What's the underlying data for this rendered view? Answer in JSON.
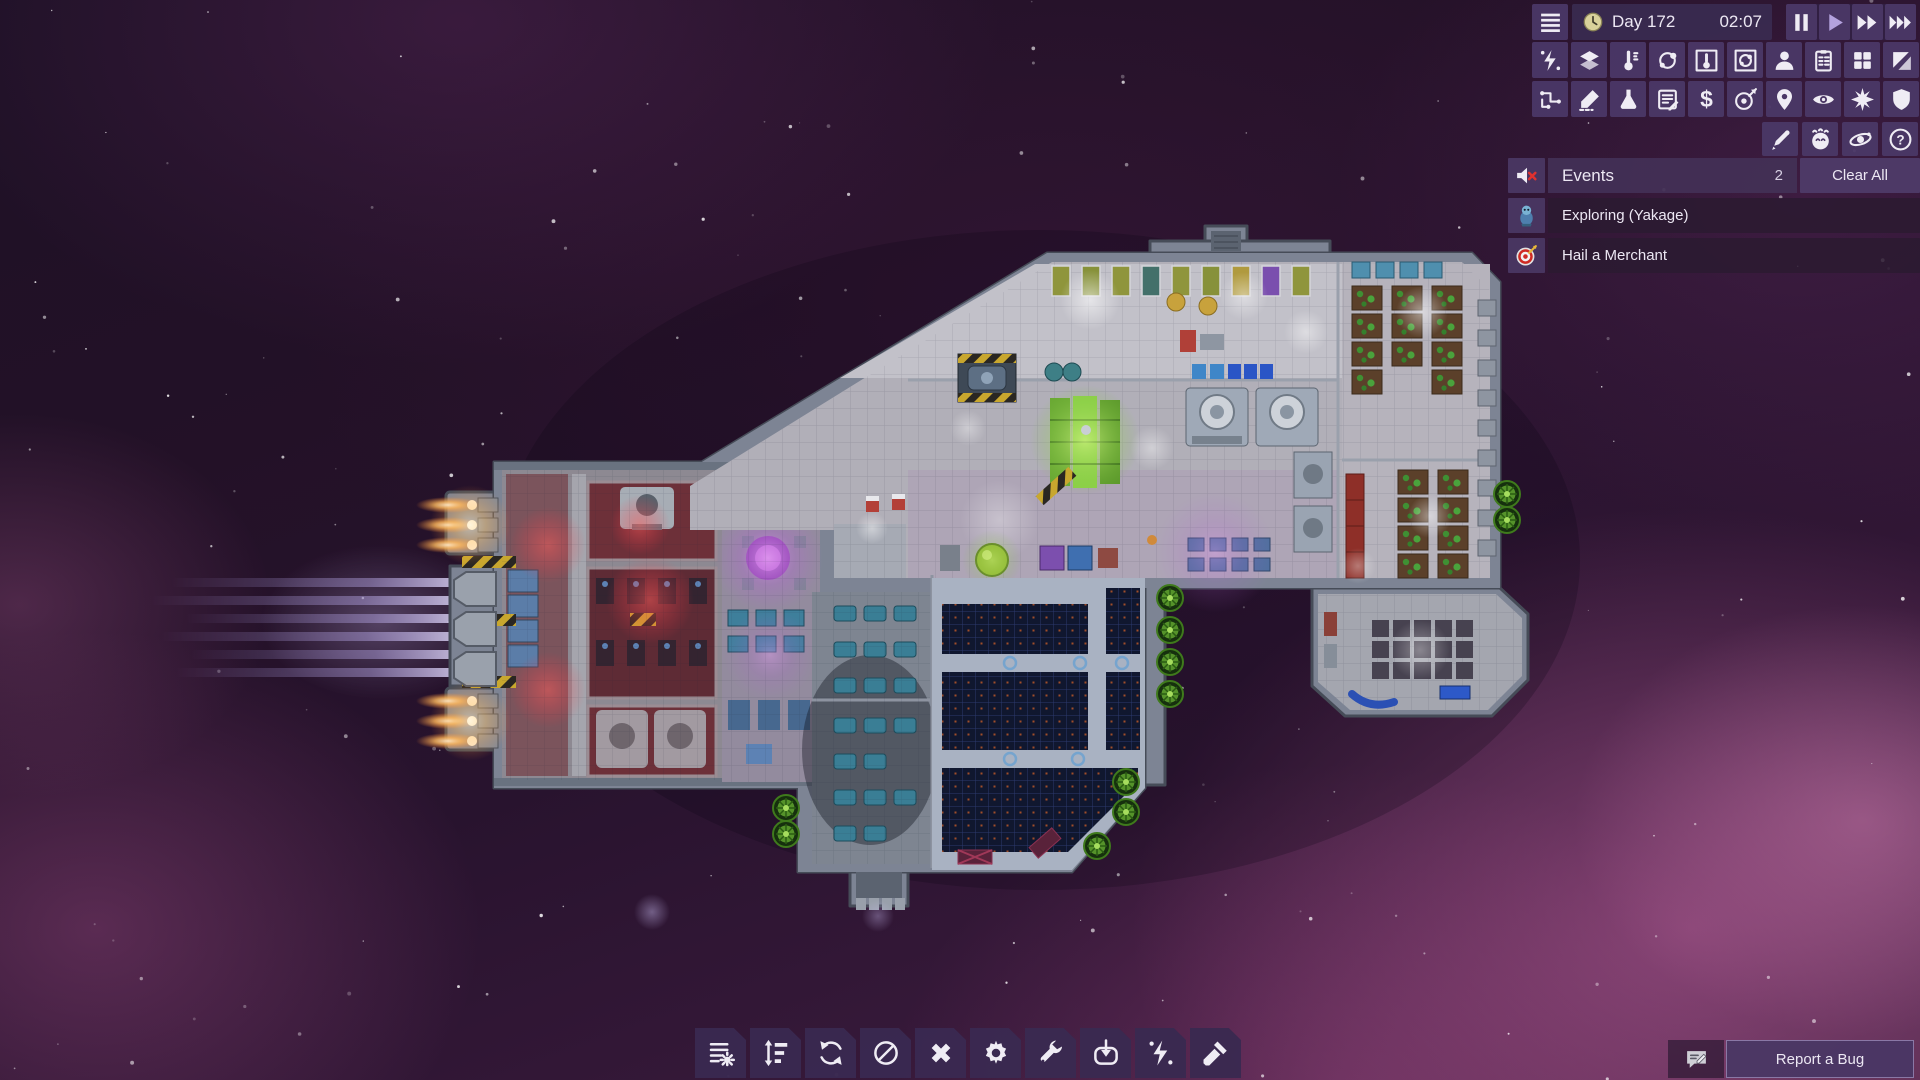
{
  "hud": {
    "menu_icon": "hamburger-menu",
    "clock_icon": "clock",
    "day": "Day 172",
    "time": "02:07",
    "speed_controls": [
      "pause",
      "play",
      "fast-forward",
      "fastest-forward"
    ],
    "active_speed": "play"
  },
  "toolbar": {
    "row1": [
      "power",
      "layers",
      "temperature",
      "gas",
      "temperature-overlay",
      "gas-overlay",
      "crew",
      "tasks-clipboard",
      "rooms-grid",
      "floor-tiles"
    ],
    "row1_selected": [
      "temperature-overlay",
      "gas-overlay"
    ],
    "row2": [
      "logistics-pipes",
      "draw-pencil",
      "research-flask",
      "data-logs",
      "trade-dollar",
      "missions-target",
      "navigation-pin",
      "visibility-eye",
      "combat-burst",
      "defense-shield"
    ],
    "row3": [
      "paint-brush",
      "planet-moods",
      "system-view-orbit",
      "help"
    ]
  },
  "events": {
    "title": "Events",
    "count": "2",
    "clear_all_label": "Clear All",
    "mute_icon": "speaker-muted",
    "items": [
      {
        "icon": "explorer-creature",
        "label": "Exploring (Yakage)"
      },
      {
        "icon": "merchant-target",
        "label": "Hail a Merchant"
      }
    ]
  },
  "bottom_toolbar": [
    "build-list",
    "priority-sort",
    "rotate",
    "forbid",
    "cancel-x",
    "settings-gear",
    "repair-wrench",
    "import-down",
    "power-bolt",
    "deconstruct-hammer"
  ],
  "bug_report": {
    "icon": "chat-pencil",
    "label": "Report a Bug"
  },
  "colors": {
    "hud_tile": "#4a3766",
    "hud_bar": "#392a50",
    "event_row": "#2b1a31",
    "active_play": "#b4a2de",
    "mute_x": "#e0312e",
    "nebula_pink": "#cd69a8",
    "hull_gray": "#7d8494",
    "solar_navy": "#10172f",
    "engine_flame": "#ffba5e",
    "pod_green": "#5f9f28"
  }
}
